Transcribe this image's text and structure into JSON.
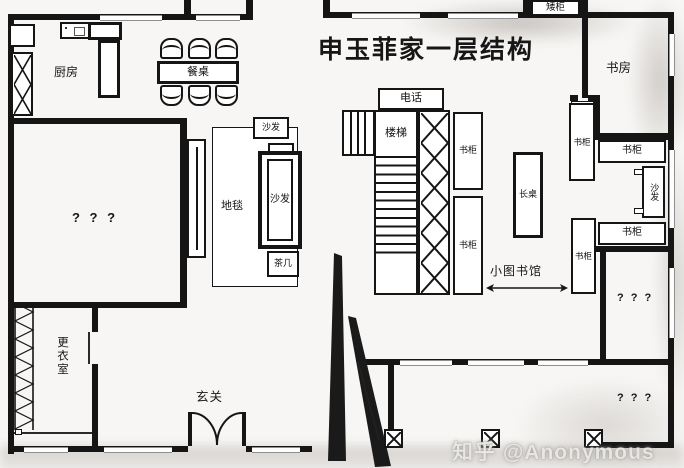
{
  "title": "申玉菲家一层结构",
  "watermark": "知乎 @Anonymous",
  "labels": {
    "kitchen": "厨房",
    "dining_table": "餐桌",
    "low_cabinet": "矮柜",
    "study": "书房",
    "phone": "电话",
    "stairs": "楼梯",
    "bookcase": "书柜",
    "carpet": "地毯",
    "sofa": "沙发",
    "tea_table": "茶几",
    "long_table": "长桌",
    "small_library": "小图书馆",
    "unknown_room": "? ? ?",
    "dressing_room": "更衣室",
    "entrance": "玄关"
  },
  "colors": {
    "wall": "#151515",
    "background": "#f7f6f4",
    "watermark": "#e7e6e3"
  }
}
